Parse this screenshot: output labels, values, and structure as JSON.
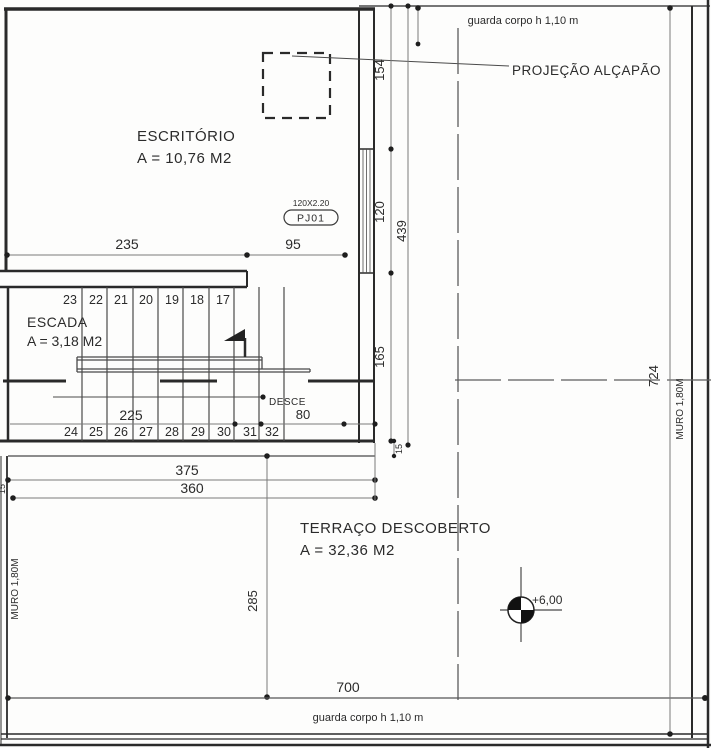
{
  "plan": {
    "rooms": {
      "escritorio": {
        "name": "ESCRITÓRIO",
        "area": "A = 10,76 M2"
      },
      "escada": {
        "name": "ESCADA",
        "area": "A = 3,18 M2"
      },
      "terraco": {
        "name": "TERRAÇO DESCOBERTO",
        "area": "A = 32,36 M2"
      }
    },
    "labels": {
      "guarda_corpo_top": "guarda corpo h 1,10 m",
      "guarda_corpo_bottom": "guarda corpo h 1,10 m",
      "projecao_alcapao": "PROJEÇÃO ALÇAPÃO",
      "desce": "DESCE",
      "muro_left": "MURO 1,80M",
      "muro_right": "MURO 1,80M",
      "level_mark": "+6,00",
      "window_size": "120X2.20",
      "window_tag": "PJ01"
    },
    "dims": {
      "w235": "235",
      "w95": "95",
      "h154": "154",
      "h120": "120",
      "h439": "439",
      "h165": "165",
      "t15_right": "15",
      "t15_left": "15",
      "w225": "225",
      "w80": "80",
      "w375": "375",
      "w360": "360",
      "h285": "285",
      "w700": "700",
      "h724": "724"
    },
    "steps_upper": [
      "23",
      "22",
      "21",
      "20",
      "19",
      "18",
      "17"
    ],
    "steps_lower": [
      "24",
      "25",
      "26",
      "27",
      "28",
      "29",
      "30",
      "31",
      "32"
    ],
    "colors": {
      "line": "#2a2a2a",
      "dim_line": "#7a7a7a",
      "text": "#2b2b2b",
      "bg": "#fdfdfc"
    }
  }
}
